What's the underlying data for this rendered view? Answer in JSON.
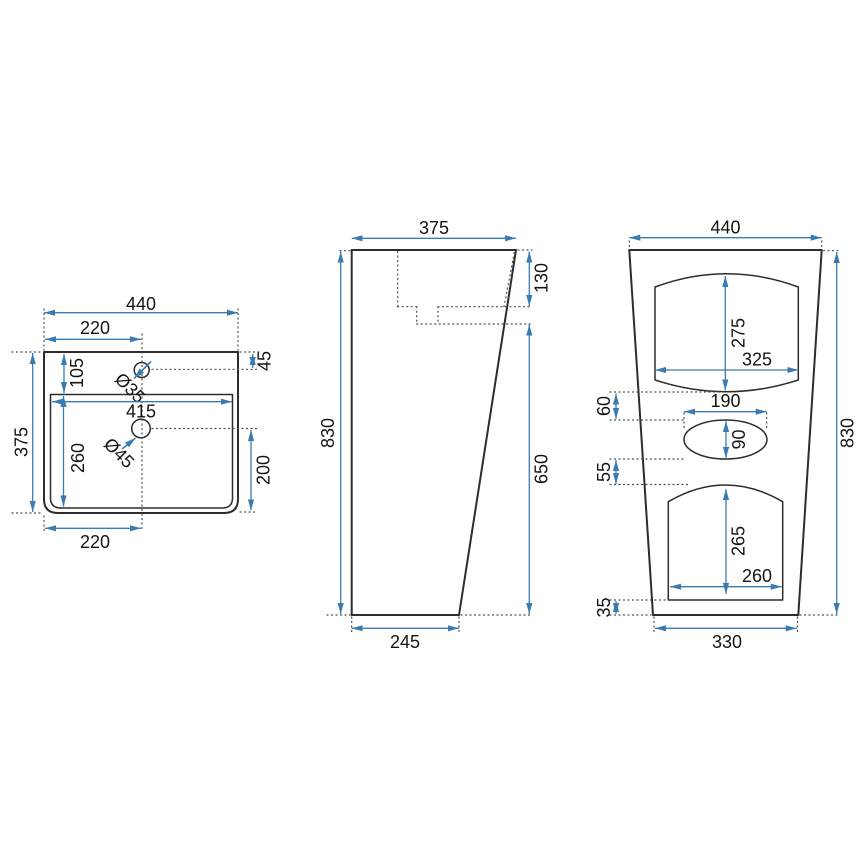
{
  "meta": {
    "drawing_type": "washbasin-technical-drawing",
    "colors": {
      "outline": "#2d2d2d",
      "hidden_line": "#4b4b4b",
      "dimension": "#3a7cb0",
      "text": "#141414",
      "background": "#ffffff"
    }
  },
  "views": {
    "top": {
      "overall_width": "440",
      "left_to_center_top": "220",
      "rim_to_basin": "105",
      "rim_to_faucet": "45",
      "faucet_hole": "Ø35",
      "basin_width": "415",
      "drain_hole": "Ø45",
      "basin_front_depth": "260",
      "drain_to_front": "200",
      "left_to_center_bottom": "220",
      "overall_depth": "375"
    },
    "side": {
      "top_depth": "375",
      "overall_height": "830",
      "basin_depth": "130",
      "lower_height": "650",
      "bottom_depth": "245"
    },
    "front": {
      "top_width": "440",
      "overall_height": "830",
      "recess_height": "275",
      "recess_width": "325",
      "recess_to_overflow": "60",
      "overflow_width": "190",
      "overflow_height": "90",
      "overflow_to_opening": "55",
      "opening_height": "265",
      "opening_width": "260",
      "opening_to_floor": "35",
      "bottom_width": "330"
    }
  }
}
